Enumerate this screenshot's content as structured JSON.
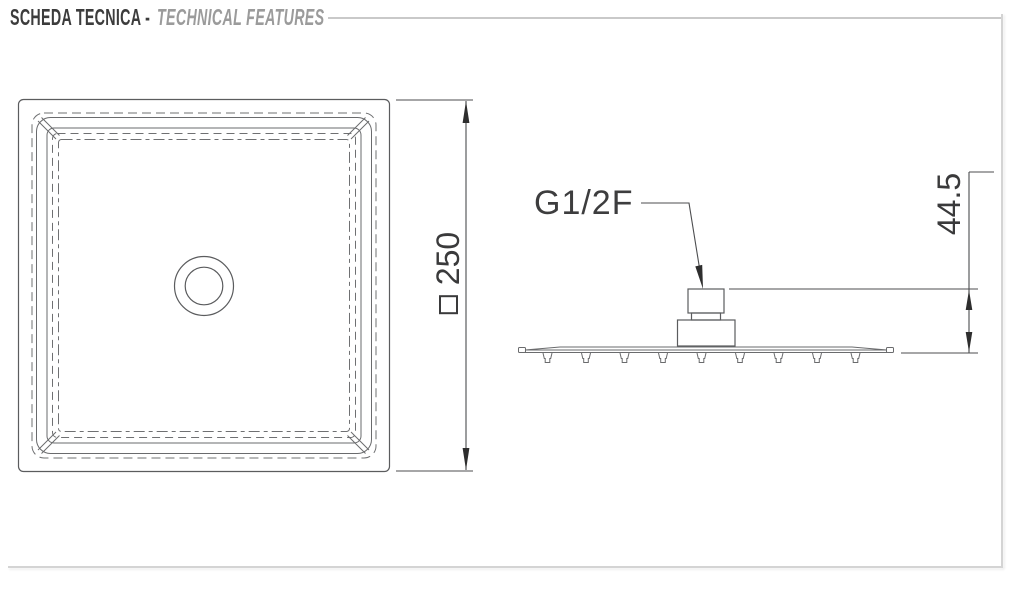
{
  "header": {
    "title_primary": "SCHEDA TECNICA -",
    "title_secondary": "TECHNICAL FEATURES"
  },
  "top_view": {
    "description": "square shower head, plan view",
    "width_dimension": {
      "symbol": "□",
      "value": "250"
    }
  },
  "side_view": {
    "description": "shower head profile with threaded inlet",
    "connection_label": "G1/2F",
    "height_dimension": {
      "value": "44.5"
    }
  },
  "colors": {
    "title_primary": "#3c3c3c",
    "title_secondary": "#9b9b9b",
    "rule": "#c9c9c9",
    "frame_border": "#d4d4d4",
    "drawing_line": "#5b5c5e",
    "dimension_text": "#3a3a3b",
    "arrow_fill": "#2e2e2e",
    "background": "#ffffff"
  }
}
